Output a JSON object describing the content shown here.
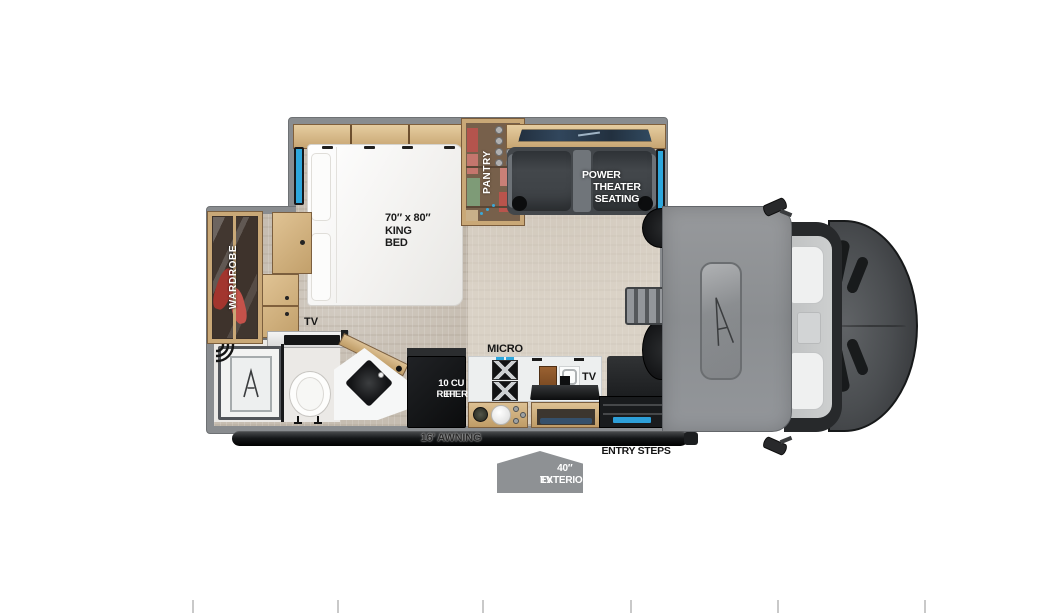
{
  "labels": {
    "bedroom": {
      "bed_size": "70″ x 80″",
      "bed_type_line1": "KING",
      "bed_type_line2": "BED",
      "wardrobe": "WARDROBE",
      "tv": "TV"
    },
    "galley": {
      "pantry": "PANTRY",
      "micro": "MICRO",
      "refer_line1": "10 CU FT",
      "refer_line2": "REFER",
      "tv": "TV"
    },
    "living": {
      "theater_line1": "POWER",
      "theater_line2": "THEATER SEATING"
    },
    "exterior": {
      "awning": "16' AWNING",
      "entry_steps": "ENTRY STEPS",
      "exterior_tv_line1": "40″ EXTERIOR",
      "exterior_tv_line2": "TV"
    }
  },
  "colors": {
    "window_accent": "#2ea7dc",
    "wall_gray": "#898c8f",
    "carpet": "#c6bdb1",
    "wood": "#c8a673",
    "seat_dark": "#3b3f43",
    "fridge_black": "#141619",
    "awning_black": "#151719",
    "tag_gray": "#8e9194",
    "entry_strip_blue": "#2d9fd8",
    "hood_gray": "#4a4d50"
  },
  "icons": {
    "overcab_logo": "brand-a-icon",
    "shower_drain": "brand-a-icon",
    "showerhead": "showerhead-icon"
  }
}
